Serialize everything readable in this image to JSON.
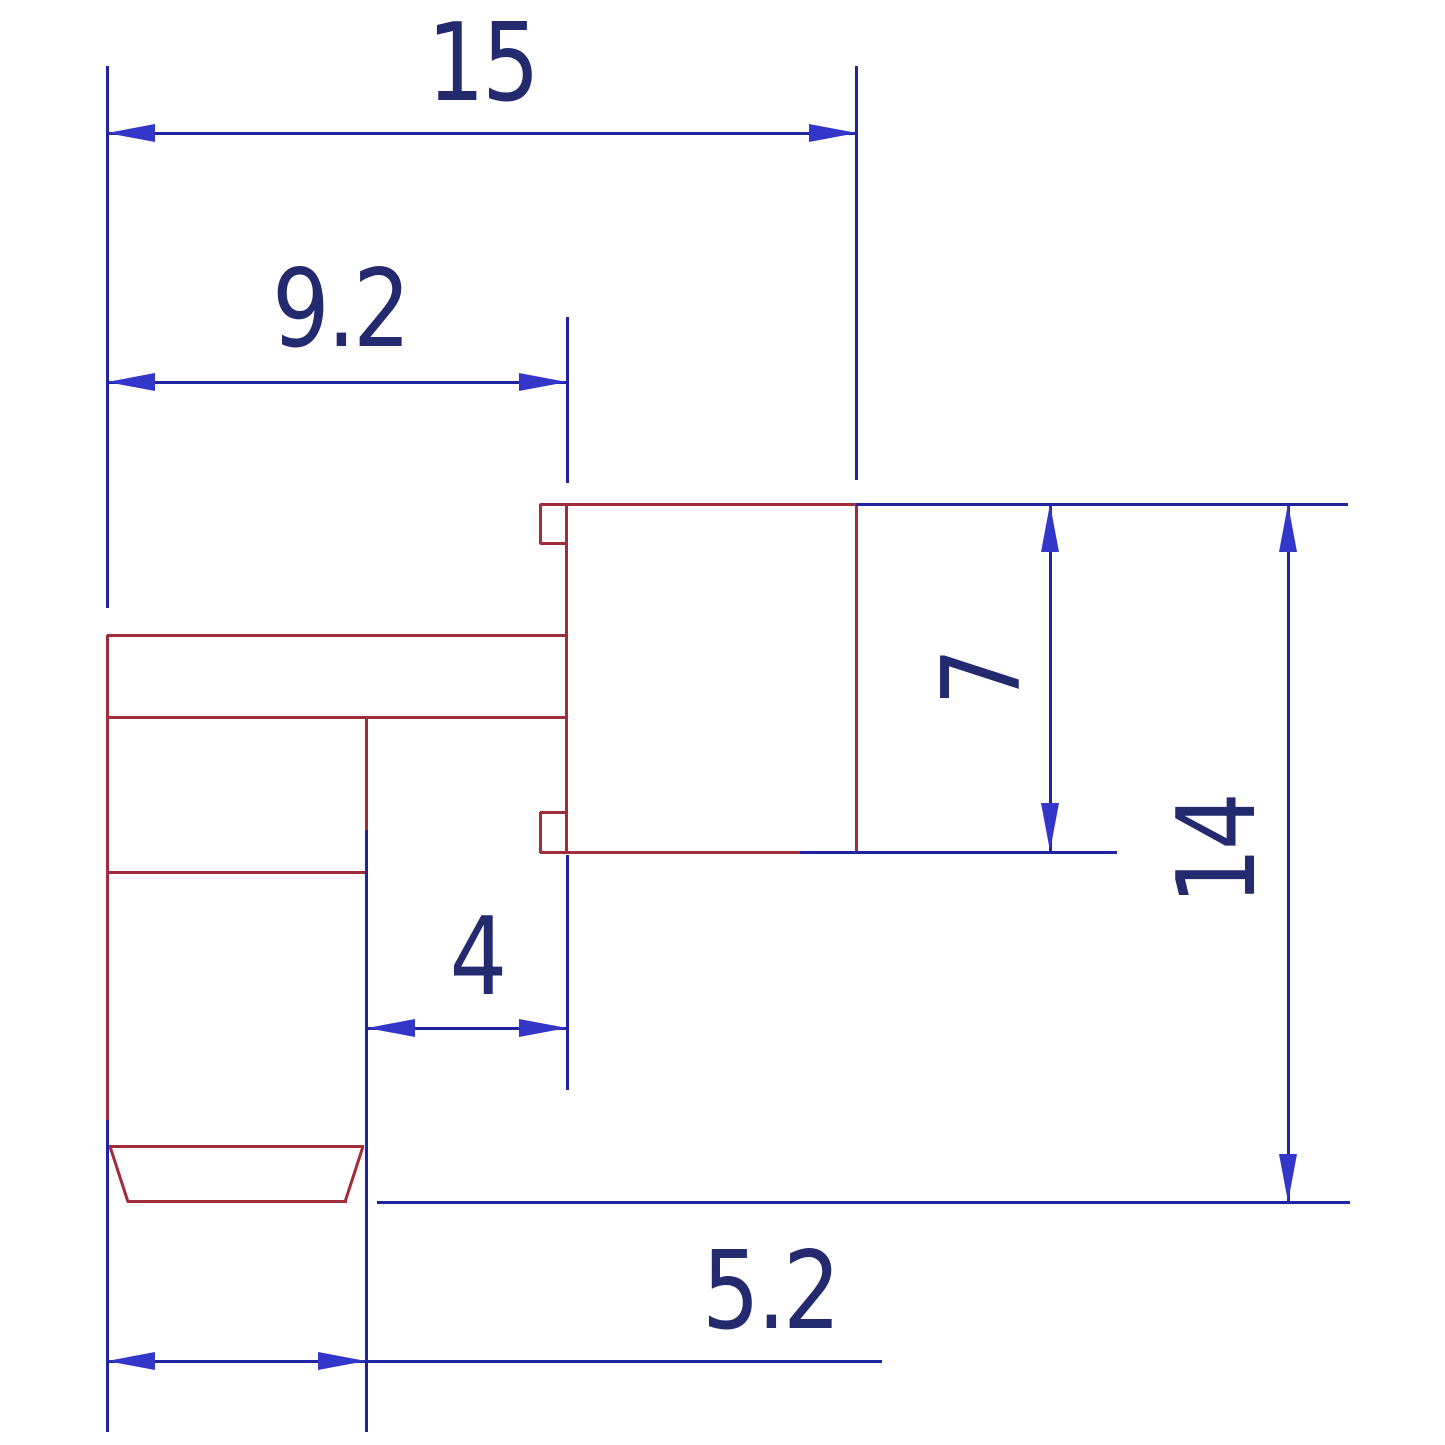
{
  "drawing": {
    "type": "engineering-dimension-drawing",
    "labels": {
      "total_width": "15",
      "upper_width": "9.2",
      "body_height": "7",
      "total_height": "14",
      "pin_gap": "4",
      "foot_width": "5.2"
    },
    "colors": {
      "outline": "#a12c3c",
      "dimension_line": "#2024a0",
      "arrow": "#3336c8",
      "label_text": "#232a6e",
      "background": "#ffffff"
    }
  }
}
